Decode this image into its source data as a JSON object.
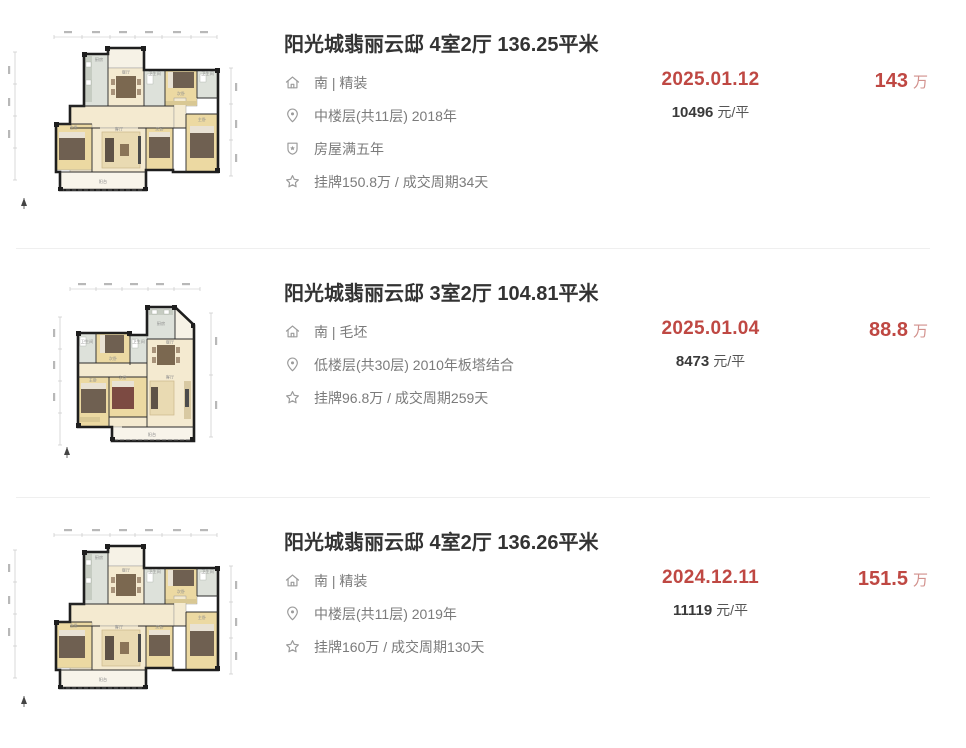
{
  "colors": {
    "highlight_red": "#bf4843",
    "highlight_red_light": "#d2918d",
    "title_dark": "#333333",
    "detail_gray": "#7b7b7b"
  },
  "floorplan_labels": {
    "kitchen": "厨房",
    "dining": "餐厅",
    "living": "客厅",
    "master": "主卧",
    "second": "次卧",
    "bath": "卫生间",
    "balcony": "阳台"
  },
  "listings": [
    {
      "title": "阳光城翡丽云邸 4室2厅 136.25平米",
      "details": [
        {
          "icon": "house-icon",
          "text": "南 | 精装"
        },
        {
          "icon": "location-icon",
          "text": "中楼层(共11层) 2018年"
        },
        {
          "icon": "shield-icon",
          "text": "房屋满五年"
        },
        {
          "icon": "star-icon",
          "text": "挂牌150.8万 / 成交周期34天"
        }
      ],
      "deal_date": "2025.01.12",
      "unit_price": "10496",
      "unit_price_suffix": "元/平",
      "total_price": "143",
      "total_price_unit": "万"
    },
    {
      "title": "阳光城翡丽云邸 3室2厅 104.81平米",
      "details": [
        {
          "icon": "house-icon",
          "text": "南 | 毛坯"
        },
        {
          "icon": "location-icon",
          "text": "低楼层(共30层) 2010年板塔结合"
        },
        {
          "icon": "star-icon",
          "text": "挂牌96.8万 / 成交周期259天"
        }
      ],
      "deal_date": "2025.01.04",
      "unit_price": "8473",
      "unit_price_suffix": "元/平",
      "total_price": "88.8",
      "total_price_unit": "万"
    },
    {
      "title": "阳光城翡丽云邸 4室2厅 136.26平米",
      "details": [
        {
          "icon": "house-icon",
          "text": "南 | 精装"
        },
        {
          "icon": "location-icon",
          "text": "中楼层(共11层) 2019年"
        },
        {
          "icon": "star-icon",
          "text": "挂牌160万 / 成交周期130天"
        }
      ],
      "deal_date": "2024.12.11",
      "unit_price": "11119",
      "unit_price_suffix": "元/平",
      "total_price": "151.5",
      "total_price_unit": "万"
    }
  ]
}
